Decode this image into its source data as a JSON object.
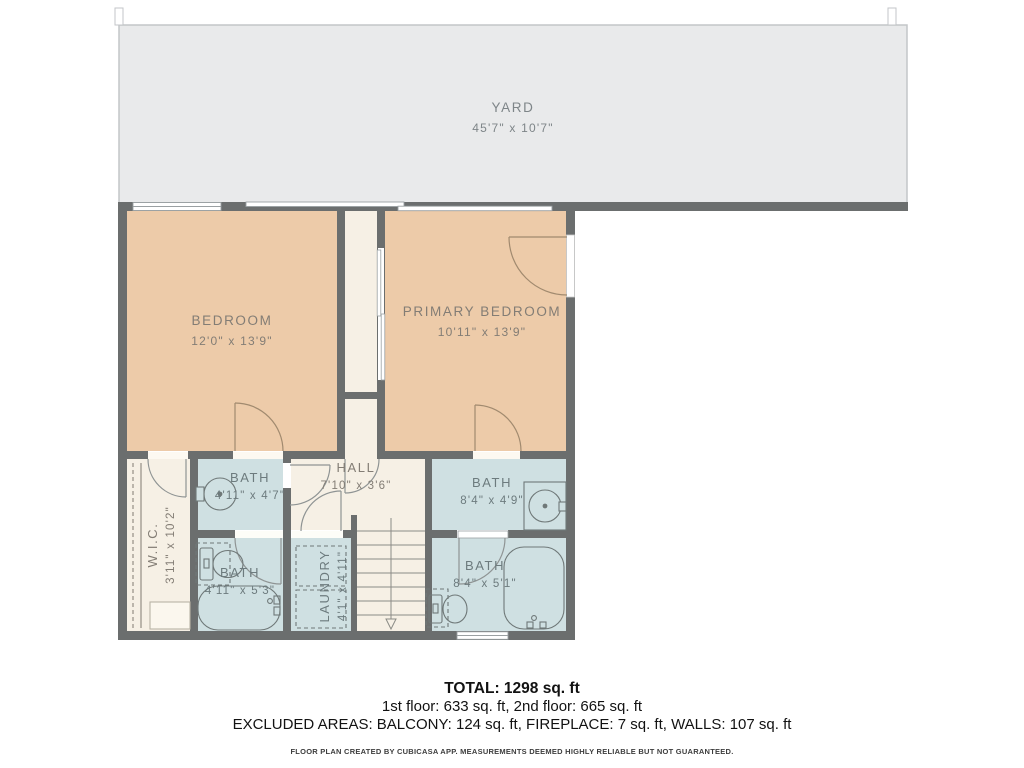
{
  "rooms": {
    "yard": {
      "name": "YARD",
      "dims": "45'7\" x 10'7\""
    },
    "bedroom": {
      "name": "BEDROOM",
      "dims": "12'0\" x 13'9\""
    },
    "primary_bedroom": {
      "name": "PRIMARY BEDROOM",
      "dims": "10'11\" x 13'9\""
    },
    "hall": {
      "name": "HALL",
      "dims": "7'10\" x 3'6\""
    },
    "bath_top_left": {
      "name": "BATH",
      "dims": "4'11\" x 4'7\""
    },
    "bath_top_right": {
      "name": "BATH",
      "dims": "8'4\" x 4'9\""
    },
    "wic": {
      "name": "W.I.C.",
      "dims": "3'11\" x 10'2\""
    },
    "bath_bottom_left": {
      "name": "BATH",
      "dims": "4'11\" x 5'3\""
    },
    "laundry": {
      "name": "LAUNDRY",
      "dims": "4'1\" x 4'11\""
    },
    "bath_bottom_right": {
      "name": "BATH",
      "dims": "8'4\" x 5'1\""
    }
  },
  "summary": {
    "total": "TOTAL: 1298 sq. ft",
    "floors": "1st floor: 633 sq. ft, 2nd floor: 665 sq. ft",
    "excluded": "EXCLUDED AREAS: BALCONY: 124 sq. ft, FIREPLACE: 7 sq. ft, WALLS: 107 sq. ft"
  },
  "footer": {
    "disclaimer": "FLOOR PLAN CREATED BY CUBICASA APP. MEASUREMENTS DEEMED HIGHLY RELIABLE BUT NOT GUARANTEED."
  },
  "colors": {
    "wall": "#6b6e6e",
    "bedroom_fill": "#edcba9",
    "bath_fill": "#cfe0e2",
    "hall_fill": "#f6f0e5",
    "yard_fill": "#e9eaeb",
    "room_label_text": "#837d75",
    "bath_label_text": "#6d7b7e",
    "summary_text": "#121212"
  }
}
